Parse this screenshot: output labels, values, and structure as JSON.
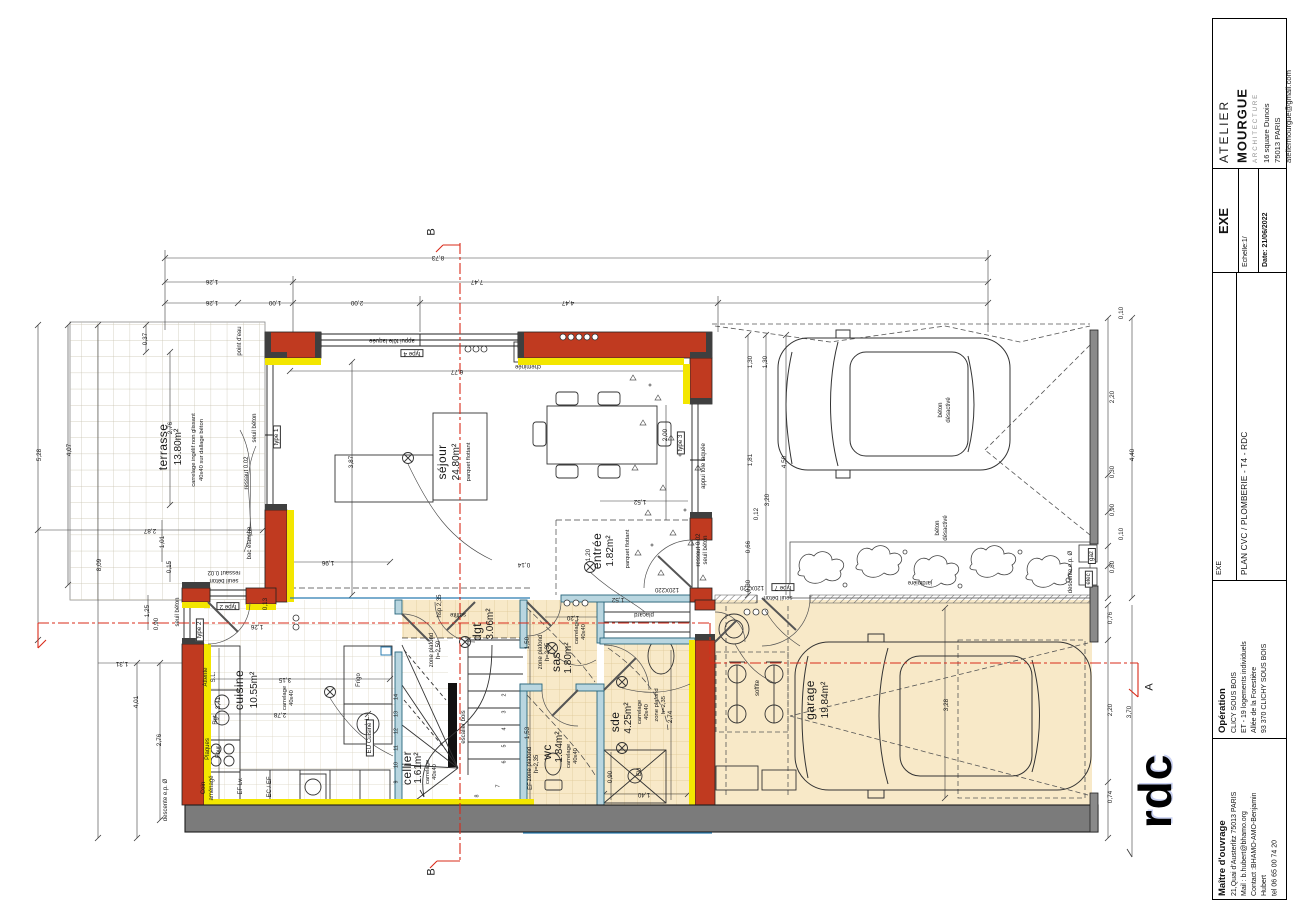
{
  "title_block": {
    "agency": {
      "line1": "ATELIER",
      "line2": "MOURGUE",
      "line3": "ARCHITECTURE",
      "address1": "16 square Dunois",
      "address2": "75013 PARIS",
      "email": "ateliermourgue@gmail.com"
    },
    "phase": "EXE",
    "scale_label": "Echelle:1/",
    "date_label": "Date: 21/06/2022",
    "doc_phase": "EXE",
    "doc_title": "PLAN CVC / PLOMBERIE - T4 - RDC",
    "operation": {
      "heading": "Opération",
      "lines": [
        "CLICY SOUS BOIS",
        "ET - 19 logements individuels",
        "Allée de la Forestière",
        "93 370 CLICHY SOUS BOIS"
      ]
    },
    "owner": {
      "heading": "Maître d'ouvrage",
      "lines": [
        "21,Quai d'Austerlitz 75013 PARIS",
        "Mail : b.hubert@bhamo.org",
        "Contact :BHAMO-AMO-Benjamin",
        "Hubert",
        "tel 06 65 00 74 20"
      ]
    }
  },
  "plan": {
    "floor_label": "rdc",
    "labels": [
      {
        "t": "B",
        "x": 432,
        "y": 232,
        "r": -90,
        "k": "sec"
      },
      {
        "t": "B",
        "x": 432,
        "y": 872,
        "r": -90,
        "k": "sec"
      },
      {
        "t": "A",
        "x": 1150,
        "y": 687,
        "r": -90,
        "k": "sec"
      },
      {
        "t": "8,73",
        "x": 438,
        "y": 257,
        "r": 180,
        "k": "dim"
      },
      {
        "t": "1,26",
        "x": 212,
        "y": 281,
        "r": 180,
        "k": "dim"
      },
      {
        "t": "7,47",
        "x": 477,
        "y": 281,
        "r": 180,
        "k": "dim"
      },
      {
        "t": "1,26",
        "x": 212,
        "y": 302,
        "r": 180,
        "k": "dim"
      },
      {
        "t": "1,00",
        "x": 275,
        "y": 302,
        "r": 180,
        "k": "dim"
      },
      {
        "t": "2,00",
        "x": 357,
        "y": 302,
        "r": 180,
        "k": "dim"
      },
      {
        "t": "4,47",
        "x": 568,
        "y": 302,
        "r": 180,
        "k": "dim"
      },
      {
        "t": "5,28",
        "x": 40,
        "y": 455,
        "r": -90,
        "k": "dim"
      },
      {
        "t": "4,07",
        "x": 70,
        "y": 450,
        "r": -90,
        "k": "dim"
      },
      {
        "t": "8,09",
        "x": 100,
        "y": 565,
        "r": -90,
        "k": "dim"
      },
      {
        "t": "0,37",
        "x": 146,
        "y": 339,
        "r": -90,
        "k": "dim"
      },
      {
        "t": "2,76",
        "x": 171,
        "y": 428,
        "r": -90,
        "k": "dim"
      },
      {
        "t": "2,87",
        "x": 150,
        "y": 530,
        "r": 180,
        "k": "dim"
      },
      {
        "t": "1,01",
        "x": 163,
        "y": 542,
        "r": -90,
        "k": "dim"
      },
      {
        "t": "0,15",
        "x": 170,
        "y": 567,
        "r": -90,
        "k": "dim"
      },
      {
        "t": "1,25",
        "x": 148,
        "y": 611,
        "r": -90,
        "k": "dim"
      },
      {
        "t": "0,90",
        "x": 157,
        "y": 624,
        "r": -90,
        "k": "dim"
      },
      {
        "t": "1,31",
        "x": 122,
        "y": 663,
        "r": 180,
        "k": "dim"
      },
      {
        "t": "4,01",
        "x": 137,
        "y": 702,
        "r": -90,
        "k": "dim"
      },
      {
        "t": "2,76",
        "x": 160,
        "y": 740,
        "r": -90,
        "k": "dim"
      },
      {
        "t": "descente e.p. Ø",
        "x": 166,
        "y": 800,
        "r": -90,
        "k": "note"
      },
      {
        "t": "0,10",
        "x": 1122,
        "y": 313,
        "r": -90,
        "k": "dim"
      },
      {
        "t": "2,20",
        "x": 1113,
        "y": 397,
        "r": -90,
        "k": "dim"
      },
      {
        "t": "0,30",
        "x": 1113,
        "y": 472,
        "r": -90,
        "k": "dim"
      },
      {
        "t": "0,90",
        "x": 1113,
        "y": 510,
        "r": -90,
        "k": "dim"
      },
      {
        "t": "0,10",
        "x": 1122,
        "y": 534,
        "r": -90,
        "k": "dim"
      },
      {
        "t": "0,80",
        "x": 1113,
        "y": 567,
        "r": -90,
        "k": "dim"
      },
      {
        "t": "4,40",
        "x": 1133,
        "y": 455,
        "r": -90,
        "k": "dim"
      },
      {
        "t": "0,76",
        "x": 1111,
        "y": 618,
        "r": -90,
        "k": "dim"
      },
      {
        "t": "2,20",
        "x": 1111,
        "y": 710,
        "r": -90,
        "k": "dim"
      },
      {
        "t": "0,74",
        "x": 1111,
        "y": 797,
        "r": -90,
        "k": "dim"
      },
      {
        "t": "3,70",
        "x": 1130,
        "y": 712,
        "r": -90,
        "k": "dim"
      },
      {
        "t": "1,30",
        "x": 751,
        "y": 362,
        "r": -90,
        "k": "dim"
      },
      {
        "t": "1,30",
        "x": 766,
        "y": 362,
        "r": -90,
        "k": "dim"
      },
      {
        "t": "1,81",
        "x": 751,
        "y": 460,
        "r": -90,
        "k": "dim"
      },
      {
        "t": "4,50",
        "x": 785,
        "y": 462,
        "r": -90,
        "k": "dim"
      },
      {
        "t": "3,20",
        "x": 768,
        "y": 500,
        "r": -90,
        "k": "dim"
      },
      {
        "t": "0,12",
        "x": 757,
        "y": 514,
        "r": -90,
        "k": "dim"
      },
      {
        "t": "0,66",
        "x": 749,
        "y": 547,
        "r": -90,
        "k": "dim"
      },
      {
        "t": "0,30",
        "x": 749,
        "y": 586,
        "r": -90,
        "k": "dim"
      },
      {
        "t": "3,28",
        "x": 947,
        "y": 705,
        "r": -90,
        "k": "dim"
      },
      {
        "t": "3,87",
        "x": 352,
        "y": 462,
        "r": -90,
        "k": "dim"
      },
      {
        "t": "6,77",
        "x": 457,
        "y": 371,
        "r": 180,
        "k": "dim"
      },
      {
        "t": "1,96",
        "x": 328,
        "y": 562,
        "r": 180,
        "k": "dim"
      },
      {
        "t": "1,52",
        "x": 640,
        "y": 501,
        "r": 180,
        "k": "dim"
      },
      {
        "t": "2,00",
        "x": 666,
        "y": 435,
        "r": -90,
        "k": "dim"
      },
      {
        "t": "1,20",
        "x": 589,
        "y": 555,
        "r": -90,
        "k": "dim"
      },
      {
        "t": "0,14",
        "x": 524,
        "y": 564,
        "r": 180,
        "k": "dim"
      },
      {
        "t": "3,15",
        "x": 285,
        "y": 679,
        "r": 180,
        "k": "dim"
      },
      {
        "t": "2,78",
        "x": 280,
        "y": 714,
        "r": 180,
        "k": "dim"
      },
      {
        "t": "3,41",
        "x": 219,
        "y": 703,
        "r": -90,
        "k": "dim"
      },
      {
        "t": "1,26",
        "x": 257,
        "y": 626,
        "r": 180,
        "k": "dim"
      },
      {
        "t": "0,13",
        "x": 266,
        "y": 604,
        "r": -90,
        "k": "dim"
      },
      {
        "t": "1,52",
        "x": 618,
        "y": 599,
        "r": 180,
        "k": "dim"
      },
      {
        "t": "1,20",
        "x": 573,
        "y": 617,
        "r": 180,
        "k": "dim"
      },
      {
        "t": "1,50",
        "x": 528,
        "y": 643,
        "r": -90,
        "k": "dim"
      },
      {
        "t": "1,53",
        "x": 528,
        "y": 733,
        "r": -90,
        "k": "dim"
      },
      {
        "t": "2,74",
        "x": 671,
        "y": 717,
        "r": -90,
        "k": "dim"
      },
      {
        "t": "1,40",
        "x": 644,
        "y": 794,
        "r": 180,
        "k": "dim"
      },
      {
        "t": "0,90",
        "x": 611,
        "y": 777,
        "r": -90,
        "k": "dim"
      },
      {
        "t": "terrasse",
        "x": 163,
        "y": 447,
        "r": -90,
        "k": "room"
      },
      {
        "t": "13.80m²",
        "x": 179,
        "y": 447,
        "r": -90,
        "k": "area"
      },
      {
        "t": "carrelage ingélif non glissant",
        "x": 195,
        "y": 450,
        "r": -90,
        "k": "fin"
      },
      {
        "t": "40x40 sur dallage béton",
        "x": 203,
        "y": 450,
        "r": -90,
        "k": "fin"
      },
      {
        "t": "séjour",
        "x": 442,
        "y": 462,
        "r": -90,
        "k": "room"
      },
      {
        "t": "24.80m²",
        "x": 457,
        "y": 462,
        "r": -90,
        "k": "area"
      },
      {
        "t": "parquet flottant",
        "x": 470,
        "y": 462,
        "r": -90,
        "k": "fin"
      },
      {
        "t": "entrée",
        "x": 597,
        "y": 551,
        "r": -90,
        "k": "room"
      },
      {
        "t": "1.82m²",
        "x": 611,
        "y": 551,
        "r": -90,
        "k": "area"
      },
      {
        "t": "parquet flottant",
        "x": 629,
        "y": 549,
        "r": -90,
        "k": "fin"
      },
      {
        "t": "cuisine",
        "x": 239,
        "y": 690,
        "r": -90,
        "k": "room"
      },
      {
        "t": "10.55m²",
        "x": 255,
        "y": 690,
        "r": -90,
        "k": "area"
      },
      {
        "t": "carrelage",
        "x": 286,
        "y": 698,
        "r": -90,
        "k": "fin"
      },
      {
        "t": "40x40",
        "x": 293,
        "y": 698,
        "r": -90,
        "k": "fin"
      },
      {
        "t": "cellier",
        "x": 407,
        "y": 768,
        "r": -90,
        "k": "room"
      },
      {
        "t": "1.61m²",
        "x": 419,
        "y": 768,
        "r": -90,
        "k": "area"
      },
      {
        "t": "carrelage",
        "x": 429,
        "y": 772,
        "r": -90,
        "k": "fin"
      },
      {
        "t": "40x40",
        "x": 436,
        "y": 772,
        "r": -90,
        "k": "fin"
      },
      {
        "t": "dgt",
        "x": 477,
        "y": 632,
        "r": -90,
        "k": "room"
      },
      {
        "t": "3.06m²",
        "x": 491,
        "y": 624,
        "r": -90,
        "k": "area"
      },
      {
        "t": "sas",
        "x": 556,
        "y": 662,
        "r": -90,
        "k": "room"
      },
      {
        "t": "1.80m²",
        "x": 569,
        "y": 658,
        "r": -90,
        "k": "area"
      },
      {
        "t": "carrelage",
        "x": 578,
        "y": 632,
        "r": -90,
        "k": "fin"
      },
      {
        "t": "40x40",
        "x": 585,
        "y": 632,
        "r": -90,
        "k": "fin"
      },
      {
        "t": "wc",
        "x": 547,
        "y": 752,
        "r": -90,
        "k": "room"
      },
      {
        "t": "1.84m²",
        "x": 560,
        "y": 747,
        "r": -90,
        "k": "area"
      },
      {
        "t": "carrelage",
        "x": 570,
        "y": 756,
        "r": -90,
        "k": "fin"
      },
      {
        "t": "40x40",
        "x": 577,
        "y": 756,
        "r": -90,
        "k": "fin"
      },
      {
        "t": "sde",
        "x": 615,
        "y": 722,
        "r": -90,
        "k": "room"
      },
      {
        "t": "4.25m²",
        "x": 629,
        "y": 718,
        "r": -90,
        "k": "area"
      },
      {
        "t": "carrelage",
        "x": 641,
        "y": 712,
        "r": -90,
        "k": "fin"
      },
      {
        "t": "40x40",
        "x": 648,
        "y": 712,
        "r": -90,
        "k": "fin"
      },
      {
        "t": "zone plafond",
        "x": 658,
        "y": 705,
        "r": -90,
        "k": "fin"
      },
      {
        "t": "h=2,35",
        "x": 665,
        "y": 705,
        "r": -90,
        "k": "fin"
      },
      {
        "t": "garage",
        "x": 810,
        "y": 700,
        "r": -90,
        "k": "room"
      },
      {
        "t": "19.84m²",
        "x": 826,
        "y": 700,
        "r": -90,
        "k": "area"
      },
      {
        "t": "point d'eau",
        "x": 240,
        "y": 341,
        "r": -90,
        "k": "note"
      },
      {
        "t": "appui tôle laquée",
        "x": 392,
        "y": 340,
        "r": 180,
        "k": "note"
      },
      {
        "t": "type 4",
        "x": 412,
        "y": 353,
        "r": 180,
        "k": "box"
      },
      {
        "t": "cheminée",
        "x": 528,
        "y": 366,
        "r": 180,
        "k": "note"
      },
      {
        "t": "type 1",
        "x": 277,
        "y": 437,
        "r": -90,
        "k": "box"
      },
      {
        "t": "type 3",
        "x": 681,
        "y": 443,
        "r": -90,
        "k": "box"
      },
      {
        "t": "appui tôle laquée",
        "x": 704,
        "y": 466,
        "r": -90,
        "k": "note"
      },
      {
        "t": "seuil béton",
        "x": 255,
        "y": 428,
        "r": -90,
        "k": "note"
      },
      {
        "t": "ressaut 0.02",
        "x": 247,
        "y": 473,
        "r": -90,
        "k": "note"
      },
      {
        "t": "bac étanche",
        "x": 250,
        "y": 543,
        "r": -90,
        "k": "note"
      },
      {
        "t": "ressaut 0.02",
        "x": 224,
        "y": 572,
        "r": 180,
        "k": "note"
      },
      {
        "t": "seuil béton",
        "x": 224,
        "y": 580,
        "r": 180,
        "k": "note"
      },
      {
        "t": "seuil béton",
        "x": 178,
        "y": 612,
        "r": -90,
        "k": "note"
      },
      {
        "t": "type 2",
        "x": 228,
        "y": 606,
        "r": 180,
        "k": "box"
      },
      {
        "t": "type 2",
        "x": 200,
        "y": 630,
        "r": -90,
        "k": "box"
      },
      {
        "t": "ressaut 0.02",
        "x": 699,
        "y": 550,
        "r": -90,
        "k": "note"
      },
      {
        "t": "seuil béton",
        "x": 706,
        "y": 550,
        "r": -90,
        "k": "note"
      },
      {
        "t": "120X220",
        "x": 667,
        "y": 589,
        "r": 180,
        "k": "note"
      },
      {
        "t": "120X220",
        "x": 752,
        "y": 587,
        "r": 180,
        "k": "note"
      },
      {
        "t": "type 7",
        "x": 783,
        "y": 587,
        "r": 180,
        "k": "box"
      },
      {
        "t": "seuil béton",
        "x": 778,
        "y": 597,
        "r": 180,
        "k": "note"
      },
      {
        "t": "gaz",
        "x": 1092,
        "y": 556,
        "r": -90,
        "k": "box"
      },
      {
        "t": "elec",
        "x": 1089,
        "y": 579,
        "r": -90,
        "k": "box"
      },
      {
        "t": "descente e.p. Ø",
        "x": 1071,
        "y": 572,
        "r": -90,
        "k": "note"
      },
      {
        "t": "jardinière",
        "x": 920,
        "y": 582,
        "r": 180,
        "k": "note"
      },
      {
        "t": "béton",
        "x": 941,
        "y": 410,
        "r": -90,
        "k": "note"
      },
      {
        "t": "désactivé",
        "x": 949,
        "y": 410,
        "r": -90,
        "k": "note"
      },
      {
        "t": "béton",
        "x": 938,
        "y": 528,
        "r": -90,
        "k": "note"
      },
      {
        "t": "désactivé",
        "x": 946,
        "y": 528,
        "r": -90,
        "k": "note"
      },
      {
        "t": "soffite",
        "x": 758,
        "y": 688,
        "r": -90,
        "k": "note"
      },
      {
        "t": "soffite",
        "x": 458,
        "y": 614,
        "r": 180,
        "k": "note"
      },
      {
        "t": "hsp 2,35",
        "x": 440,
        "y": 606,
        "r": -90,
        "k": "note"
      },
      {
        "t": "zone plafond",
        "x": 432,
        "y": 650,
        "r": -90,
        "k": "note"
      },
      {
        "t": "h=2,50",
        "x": 439,
        "y": 650,
        "r": -90,
        "k": "note"
      },
      {
        "t": "zone plafond",
        "x": 541,
        "y": 652,
        "r": -90,
        "k": "note"
      },
      {
        "t": "h=2,35",
        "x": 548,
        "y": 652,
        "r": -90,
        "k": "note"
      },
      {
        "t": "zone plafond",
        "x": 530,
        "y": 764,
        "r": -90,
        "k": "note"
      },
      {
        "t": "h=2,35",
        "x": 537,
        "y": 764,
        "r": -90,
        "k": "note"
      },
      {
        "t": "EF",
        "x": 531,
        "y": 786,
        "r": -90,
        "k": "note"
      },
      {
        "t": "escalier bois",
        "x": 464,
        "y": 727,
        "r": -90,
        "k": "note"
      },
      {
        "t": "Attente",
        "x": 206,
        "y": 677,
        "r": -90,
        "k": "note"
      },
      {
        "t": "S.L.",
        "x": 214,
        "y": 677,
        "r": -90,
        "k": "note"
      },
      {
        "t": "Rgt",
        "x": 216,
        "y": 720,
        "r": -90,
        "k": "note"
      },
      {
        "t": "Plaques",
        "x": 208,
        "y": 749,
        "r": -90,
        "k": "note"
      },
      {
        "t": "Four",
        "x": 219,
        "y": 752,
        "r": -90,
        "k": "note"
      },
      {
        "t": "Coin",
        "x": 204,
        "y": 788,
        "r": -90,
        "k": "note"
      },
      {
        "t": "aménagé",
        "x": 212,
        "y": 788,
        "r": -90,
        "k": "note"
      },
      {
        "t": "EF Lv.",
        "x": 241,
        "y": 786,
        "r": -90,
        "k": "note"
      },
      {
        "t": "EC / EF",
        "x": 270,
        "y": 787,
        "r": -90,
        "k": "note"
      },
      {
        "t": "Frigo",
        "x": 359,
        "y": 680,
        "r": -90,
        "k": "note"
      },
      {
        "t": "L.L.",
        "x": 368,
        "y": 720,
        "r": -90,
        "k": "note"
      },
      {
        "t": "EU Cuisine",
        "x": 370,
        "y": 738,
        "r": -90,
        "k": "box"
      },
      {
        "t": "EU",
        "x": 640,
        "y": 772,
        "r": -90,
        "k": "note"
      },
      {
        "t": "placard",
        "x": 644,
        "y": 614,
        "r": 180,
        "k": "note"
      },
      {
        "t": "2",
        "x": 505,
        "y": 695,
        "r": -90,
        "k": "tiny"
      },
      {
        "t": "3",
        "x": 505,
        "y": 712,
        "r": -90,
        "k": "tiny"
      },
      {
        "t": "4",
        "x": 505,
        "y": 729,
        "r": -90,
        "k": "tiny"
      },
      {
        "t": "5",
        "x": 505,
        "y": 746,
        "r": -90,
        "k": "tiny"
      },
      {
        "t": "6",
        "x": 505,
        "y": 762,
        "r": -90,
        "k": "tiny"
      },
      {
        "t": "7",
        "x": 499,
        "y": 786,
        "r": -90,
        "k": "tiny"
      },
      {
        "t": "8",
        "x": 478,
        "y": 796,
        "r": -90,
        "k": "tiny"
      },
      {
        "t": "14",
        "x": 397,
        "y": 697,
        "r": -90,
        "k": "tiny"
      },
      {
        "t": "13",
        "x": 397,
        "y": 714,
        "r": -90,
        "k": "tiny"
      },
      {
        "t": "12",
        "x": 397,
        "y": 731,
        "r": -90,
        "k": "tiny"
      },
      {
        "t": "11",
        "x": 397,
        "y": 748,
        "r": -90,
        "k": "tiny"
      },
      {
        "t": "10",
        "x": 397,
        "y": 765,
        "r": -90,
        "k": "tiny"
      },
      {
        "t": "9",
        "x": 397,
        "y": 782,
        "r": -90,
        "k": "tiny"
      }
    ]
  }
}
